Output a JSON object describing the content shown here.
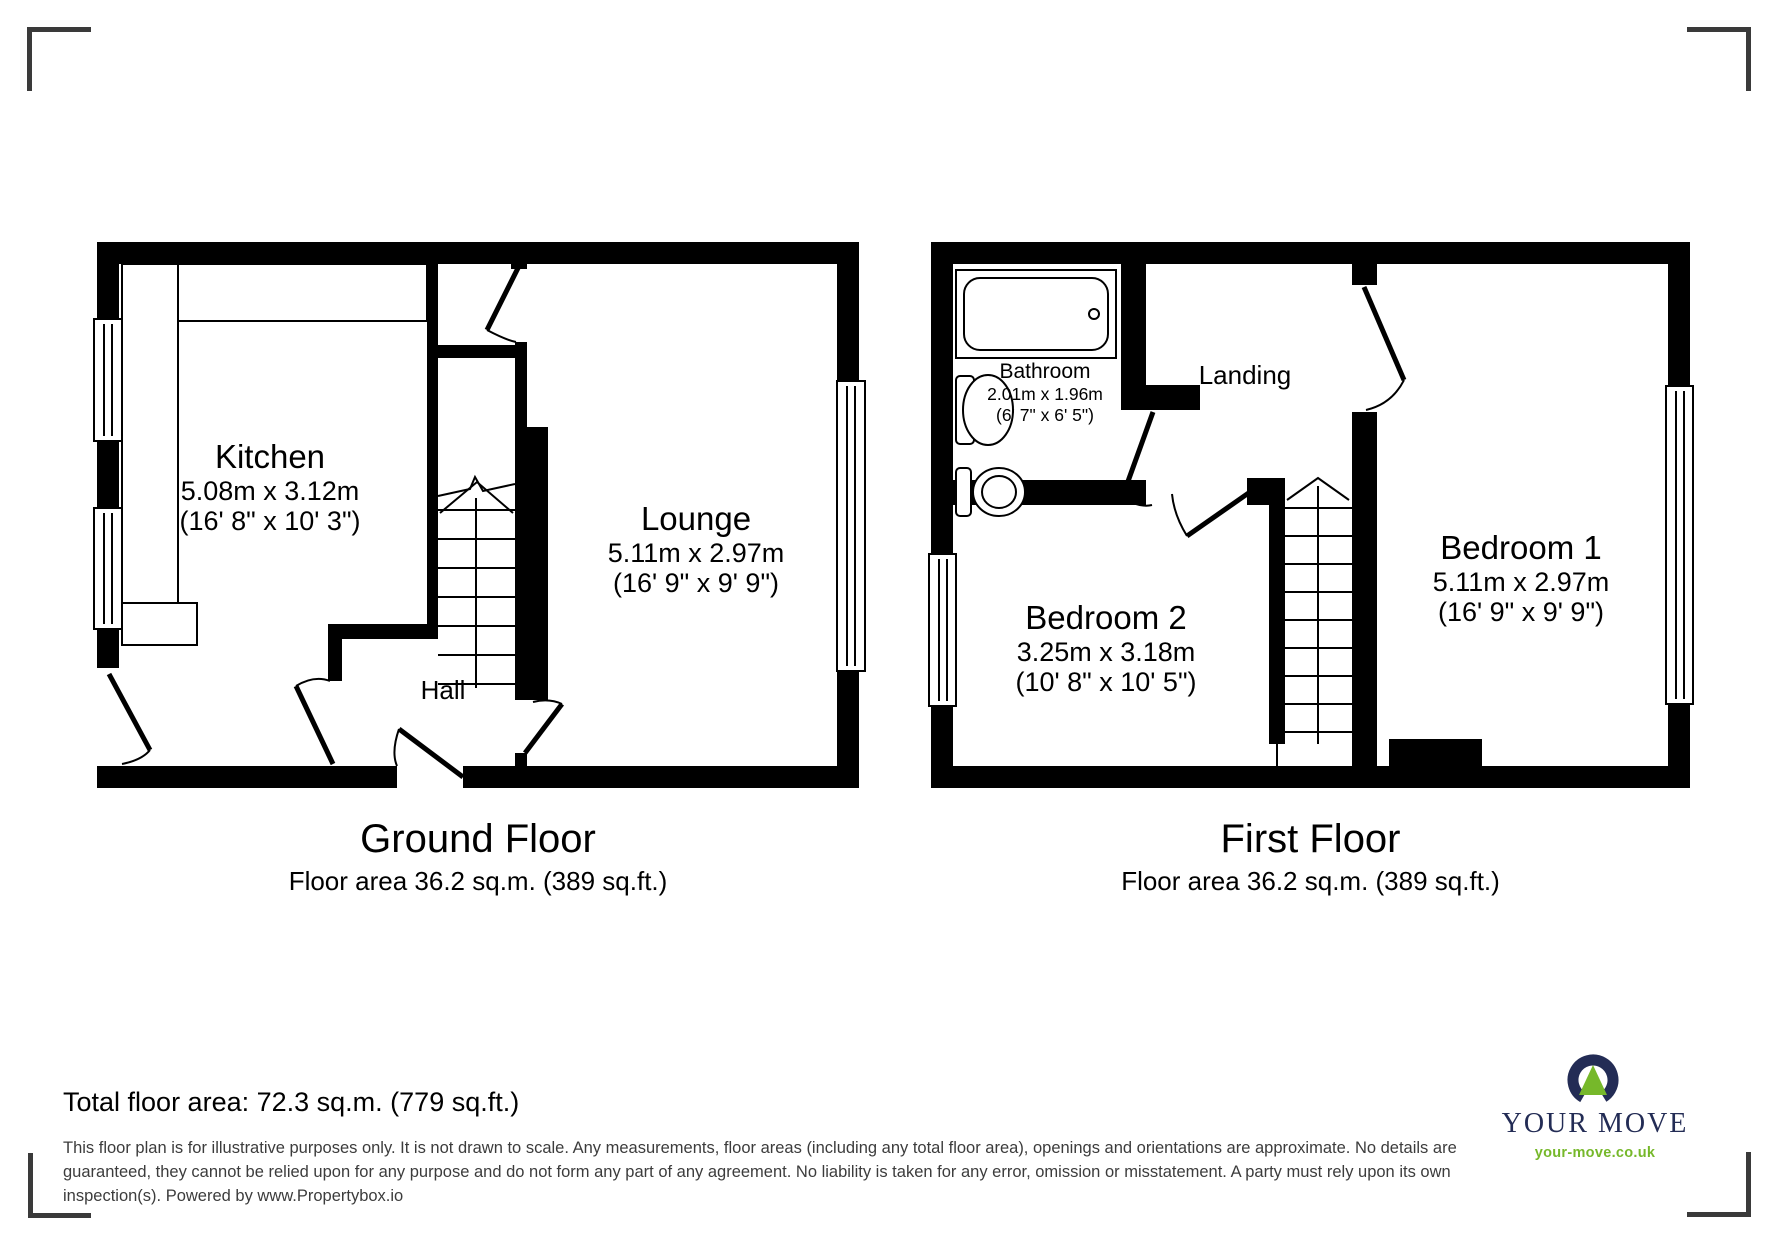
{
  "floors": [
    {
      "title": "Ground Floor",
      "area": "Floor area 36.2 sq.m. (389 sq.ft.)"
    },
    {
      "title": "First Floor",
      "area": "Floor area 36.2 sq.m. (389 sq.ft.)"
    }
  ],
  "rooms": {
    "kitchen": {
      "name": "Kitchen",
      "dim_m": "5.08m x 3.12m",
      "dim_ft": "(16' 8\" x 10' 3\")"
    },
    "lounge": {
      "name": "Lounge",
      "dim_m": "5.11m x 2.97m",
      "dim_ft": "(16' 9\" x 9' 9\")"
    },
    "hall": {
      "name": "Hall"
    },
    "bathroom": {
      "name": "Bathroom",
      "dim_m": "2.01m x 1.96m",
      "dim_ft": "(6' 7\" x 6' 5\")"
    },
    "landing": {
      "name": "Landing"
    },
    "bedroom1": {
      "name": "Bedroom 1",
      "dim_m": "5.11m x 2.97m",
      "dim_ft": "(16' 9\" x 9' 9\")"
    },
    "bedroom2": {
      "name": "Bedroom 2",
      "dim_m": "3.25m x 3.18m",
      "dim_ft": "(10' 8\" x 10' 5\")"
    }
  },
  "summary": {
    "total": "Total floor area: 72.3 sq.m. (779 sq.ft.)"
  },
  "disclaimer": {
    "line1": "This floor plan is for illustrative purposes only. It is not drawn to scale. Any measurements, floor areas (including any total floor area), openings and orientations are approximate. No details are",
    "line2": "guaranteed, they cannot be relied upon for any purpose and do not form any part of any agreement. No liability is taken for any error, omission or misstatement. A party must rely upon its own",
    "line3": "inspection(s). Powered by www.Propertybox.io"
  },
  "logo": {
    "brand": "YOUR MOVE",
    "url": "your-move.co.uk"
  },
  "colors": {
    "wall": "#000000",
    "navy": "#232c55",
    "green": "#76b82a",
    "disclaimer_gray": "#3c3c3c",
    "bracket_gray": "#3a3a3a"
  }
}
